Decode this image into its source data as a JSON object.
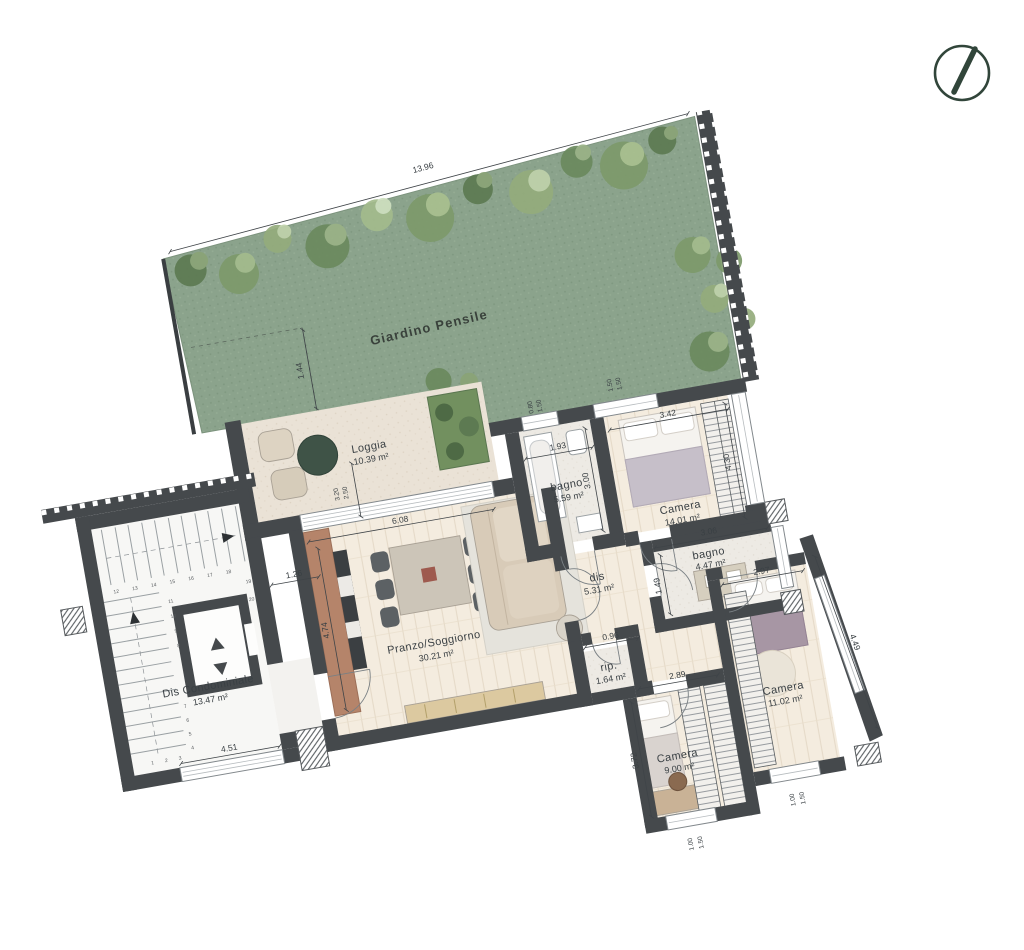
{
  "plan_title": "apartment-floor-plan",
  "garden": {
    "label": "Giardino Pensile"
  },
  "rooms": {
    "loggia": {
      "name": "Loggia",
      "area": "10.39 m²"
    },
    "living": {
      "name": "Pranzo/Soggiorno",
      "area": "30.21 m²"
    },
    "bagno1": {
      "name": "bagno",
      "area": "5.59 m²"
    },
    "camera1": {
      "name": "Camera",
      "area": "14.01 m²"
    },
    "dis": {
      "name": "dis",
      "area": "5.31 m²"
    },
    "bagno2": {
      "name": "bagno",
      "area": "4.47 m²"
    },
    "rip": {
      "name": "rip.",
      "area": "1.64 m²"
    },
    "camera2": {
      "name": "Camera",
      "area": "9.00 m²"
    },
    "camera3": {
      "name": "Camera",
      "area": "11.02 m²"
    },
    "dis_cond": {
      "name": "Dis Condominiale",
      "area": "13.47 m²"
    }
  },
  "dims": {
    "garden_w": "13.96",
    "garden_off": "1.44",
    "door_w": "3.20",
    "door_h": "2.50",
    "living_w": "6.08",
    "kitchen_l": "4.74",
    "hall_w": "1.26",
    "bagno1_w": "1.93",
    "bagno1_d": "3.00",
    "cam1_w": "3.42",
    "cam1_d": "4.30",
    "winT1_w": "0.80",
    "winT1_h": "1.50",
    "winT2_w": "1.50",
    "winT2_h": "1.50",
    "stair_win": "4.51",
    "bagno2_w": "3.06",
    "bagno2_d": "1.49",
    "rip_w": "0.96",
    "cam3_w": "2.97",
    "cam3_d": "4.49",
    "cam2_w": "2.89",
    "cam2_d": "3.72",
    "winB1_w": "1.00",
    "winB1_h": "1.50",
    "winB2_w": "1.00",
    "winB2_h": "1.50"
  },
  "stairs": {
    "numbers": [
      "1",
      "2",
      "3",
      "4",
      "5",
      "6",
      "7",
      "8",
      "9",
      "10",
      "11",
      "12",
      "13",
      "14",
      "15",
      "16",
      "17",
      "18",
      "19",
      "20"
    ]
  },
  "colors": {
    "grass": "#8ba38c",
    "wall": "#45494c",
    "compass": "#31453a"
  }
}
